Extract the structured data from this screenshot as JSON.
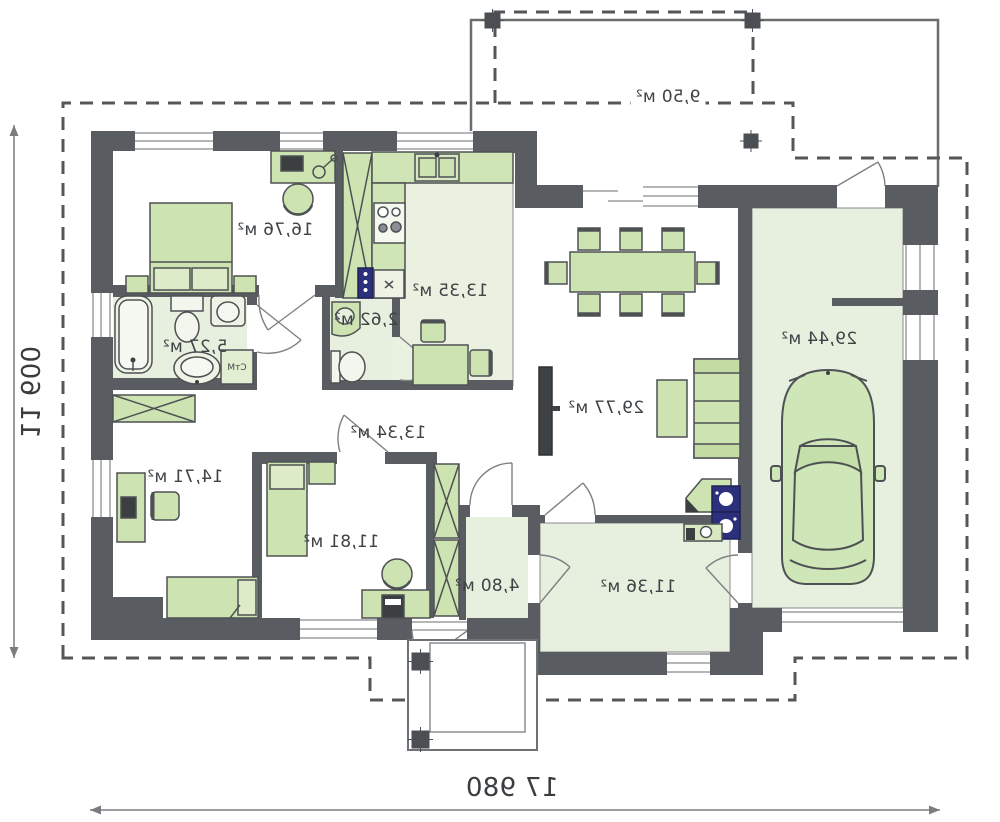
{
  "plan": {
    "title": "single-storey house floor plan (mirrored print)",
    "rooms": [
      {
        "id": "terrace",
        "area": "9,50 м²"
      },
      {
        "id": "bedroom-1",
        "area": "16,76 м²"
      },
      {
        "id": "kitchen",
        "area": "13,35 м²"
      },
      {
        "id": "wc",
        "area": "2,62 м²"
      },
      {
        "id": "bathroom",
        "area": "5,27 м²"
      },
      {
        "id": "hall",
        "area": "13,34 м²"
      },
      {
        "id": "bedroom-2",
        "area": "14,71 м²"
      },
      {
        "id": "bedroom-3",
        "area": "11,81 м²"
      },
      {
        "id": "vestibule",
        "area": "4,80 м²"
      },
      {
        "id": "utility",
        "area": "11,36 м²"
      },
      {
        "id": "living-room",
        "area": "29,77 м²"
      },
      {
        "id": "garage",
        "area": "29,44 м²"
      }
    ],
    "appliance_labels": {
      "washing_machine": "СтМ"
    },
    "dimensions": {
      "width": "17 980",
      "height": "11 600"
    },
    "colors": {
      "wall": "#595c60",
      "room_fill": "#e7efde",
      "furniture": "#cde4b2",
      "furniture_light": "#ddebc8",
      "accent_blue": "#2c2f7c",
      "dash": "#54575a"
    }
  }
}
